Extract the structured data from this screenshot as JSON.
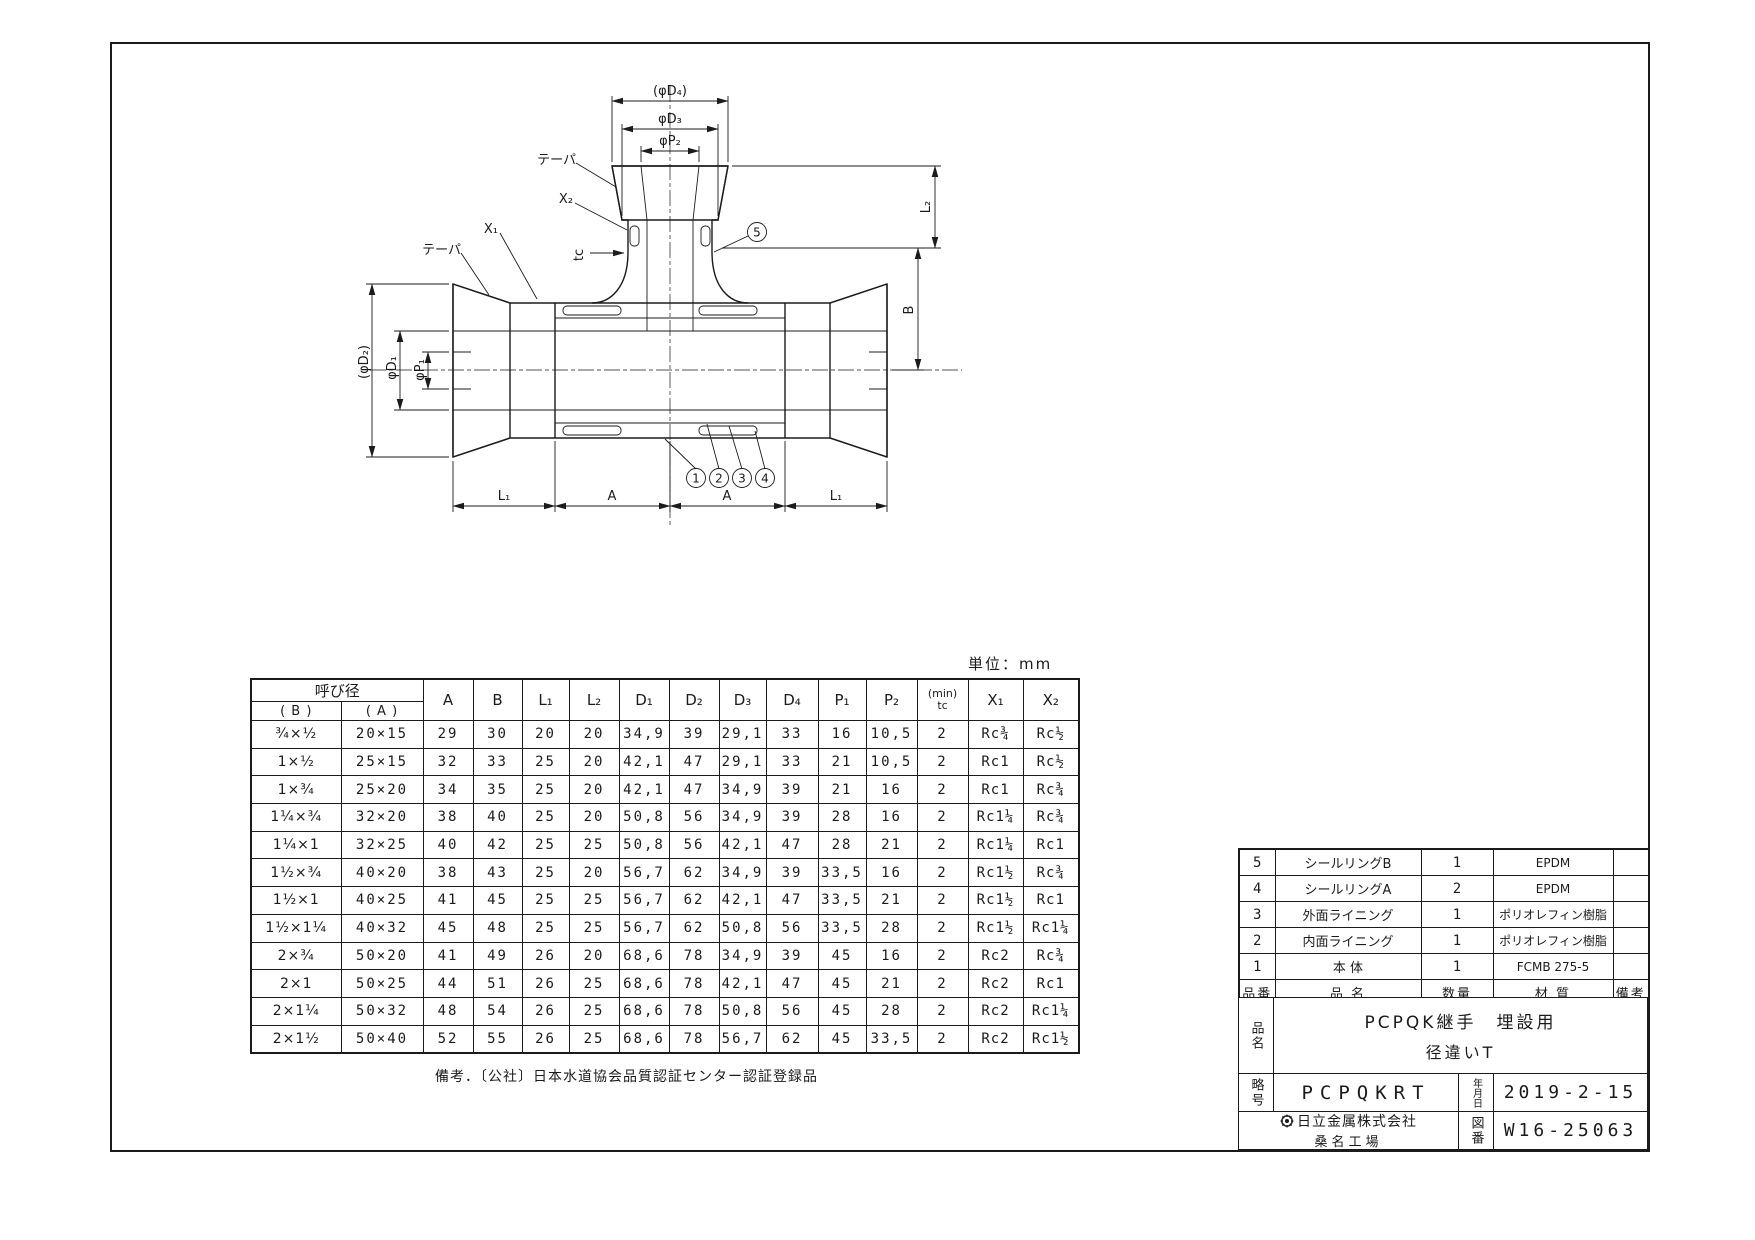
{
  "unit_label": "単位：mm",
  "note": "備考．〔公社〕日本水道協会品質認証センター認証登録品",
  "drawing": {
    "dims": {
      "phi_d4": "(φD₄)",
      "phi_d3": "φD₃",
      "phi_p2": "φP₂",
      "phi_d2": "(φD₂)",
      "phi_d1": "φD₁",
      "phi_p1": "φP₁",
      "l2": "L₂",
      "b": "B",
      "l1_left": "L₁",
      "a_left": "A",
      "a_right": "A",
      "l1_right": "L₁",
      "taper_top": "テーパ",
      "taper_left": "テーパ",
      "x2": "X₂",
      "x1": "X₁",
      "tc": "tc"
    },
    "balloons": [
      "1",
      "2",
      "3",
      "4",
      "5"
    ]
  },
  "dim_table": {
    "nominal_header": "呼び径",
    "sub_b": "( B )",
    "sub_a": "( A )",
    "cols": [
      "A",
      "B",
      "L₁",
      "L₂",
      "D₁",
      "D₂",
      "D₃",
      "D₄",
      "P₁",
      "P₂"
    ],
    "tc_line1": "(min)",
    "tc_line2": "tc",
    "x1": "X₁",
    "x2": "X₂",
    "rows": [
      [
        "¾×½",
        "20×15",
        "29",
        "30",
        "20",
        "20",
        "34,9",
        "39",
        "29,1",
        "33",
        "16",
        "10,5",
        "2",
        "Rc¾",
        "Rc½"
      ],
      [
        "1×½",
        "25×15",
        "32",
        "33",
        "25",
        "20",
        "42,1",
        "47",
        "29,1",
        "33",
        "21",
        "10,5",
        "2",
        "Rc1",
        "Rc½"
      ],
      [
        "1×¾",
        "25×20",
        "34",
        "35",
        "25",
        "20",
        "42,1",
        "47",
        "34,9",
        "39",
        "21",
        "16",
        "2",
        "Rc1",
        "Rc¾"
      ],
      [
        "1¼×¾",
        "32×20",
        "38",
        "40",
        "25",
        "20",
        "50,8",
        "56",
        "34,9",
        "39",
        "28",
        "16",
        "2",
        "Rc1¼",
        "Rc¾"
      ],
      [
        "1¼×1",
        "32×25",
        "40",
        "42",
        "25",
        "25",
        "50,8",
        "56",
        "42,1",
        "47",
        "28",
        "21",
        "2",
        "Rc1¼",
        "Rc1"
      ],
      [
        "1½×¾",
        "40×20",
        "38",
        "43",
        "25",
        "20",
        "56,7",
        "62",
        "34,9",
        "39",
        "33,5",
        "16",
        "2",
        "Rc1½",
        "Rc¾"
      ],
      [
        "1½×1",
        "40×25",
        "41",
        "45",
        "25",
        "25",
        "56,7",
        "62",
        "42,1",
        "47",
        "33,5",
        "21",
        "2",
        "Rc1½",
        "Rc1"
      ],
      [
        "1½×1¼",
        "40×32",
        "45",
        "48",
        "25",
        "25",
        "56,7",
        "62",
        "50,8",
        "56",
        "33,5",
        "28",
        "2",
        "Rc1½",
        "Rc1¼"
      ],
      [
        "2×¾",
        "50×20",
        "41",
        "49",
        "26",
        "20",
        "68,6",
        "78",
        "34,9",
        "39",
        "45",
        "16",
        "2",
        "Rc2",
        "Rc¾"
      ],
      [
        "2×1",
        "50×25",
        "44",
        "51",
        "26",
        "25",
        "68,6",
        "78",
        "42,1",
        "47",
        "45",
        "21",
        "2",
        "Rc2",
        "Rc1"
      ],
      [
        "2×1¼",
        "50×32",
        "48",
        "54",
        "26",
        "25",
        "68,6",
        "78",
        "50,8",
        "56",
        "45",
        "28",
        "2",
        "Rc2",
        "Rc1¼"
      ],
      [
        "2×1½",
        "50×40",
        "52",
        "55",
        "26",
        "25",
        "68,6",
        "78",
        "56,7",
        "62",
        "45",
        "33,5",
        "2",
        "Rc2",
        "Rc1½"
      ]
    ]
  },
  "parts_table": {
    "headers": [
      "品番",
      "品 名",
      "数量",
      "材 質",
      "備考"
    ],
    "rows": [
      [
        "5",
        "シールリングB",
        "1",
        "EPDM",
        ""
      ],
      [
        "4",
        "シールリングA",
        "2",
        "EPDM",
        ""
      ],
      [
        "3",
        "外面ライニング",
        "1",
        "ポリオレフィン樹脂",
        ""
      ],
      [
        "2",
        "内面ライニング",
        "1",
        "ポリオレフィン樹脂",
        ""
      ],
      [
        "1",
        "本 体",
        "1",
        "FCMB 275-5",
        ""
      ]
    ]
  },
  "title_block": {
    "product_label": "品名",
    "product_line1": "PCPQK継手　埋設用",
    "product_line2": "径違いT",
    "code_label": "略号",
    "code": "PCPQKRT",
    "date_label": "年月日",
    "date": "2019-2-15",
    "company": "日立金属株式会社",
    "factory": "桑名工場",
    "dwg_label": "図番",
    "dwg_no": "W16-25063"
  }
}
